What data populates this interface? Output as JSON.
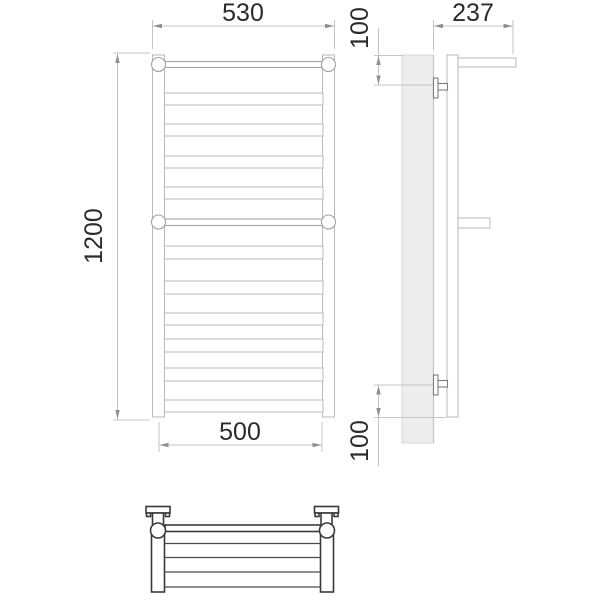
{
  "dimensions": {
    "width_top": "530",
    "height": "1200",
    "width_bottom": "500",
    "depth": "237",
    "offset_top": "100",
    "offset_bottom": "100"
  },
  "colors": {
    "outline_light": "#b9b9b9",
    "outline_dark": "#3a3a3a",
    "bracket_gray": "#7d7d7d",
    "wall_fill": "#ededed",
    "dimension_line": "#c4c4c4",
    "dimension_text": "#2b2b2b",
    "background": "#ffffff"
  }
}
